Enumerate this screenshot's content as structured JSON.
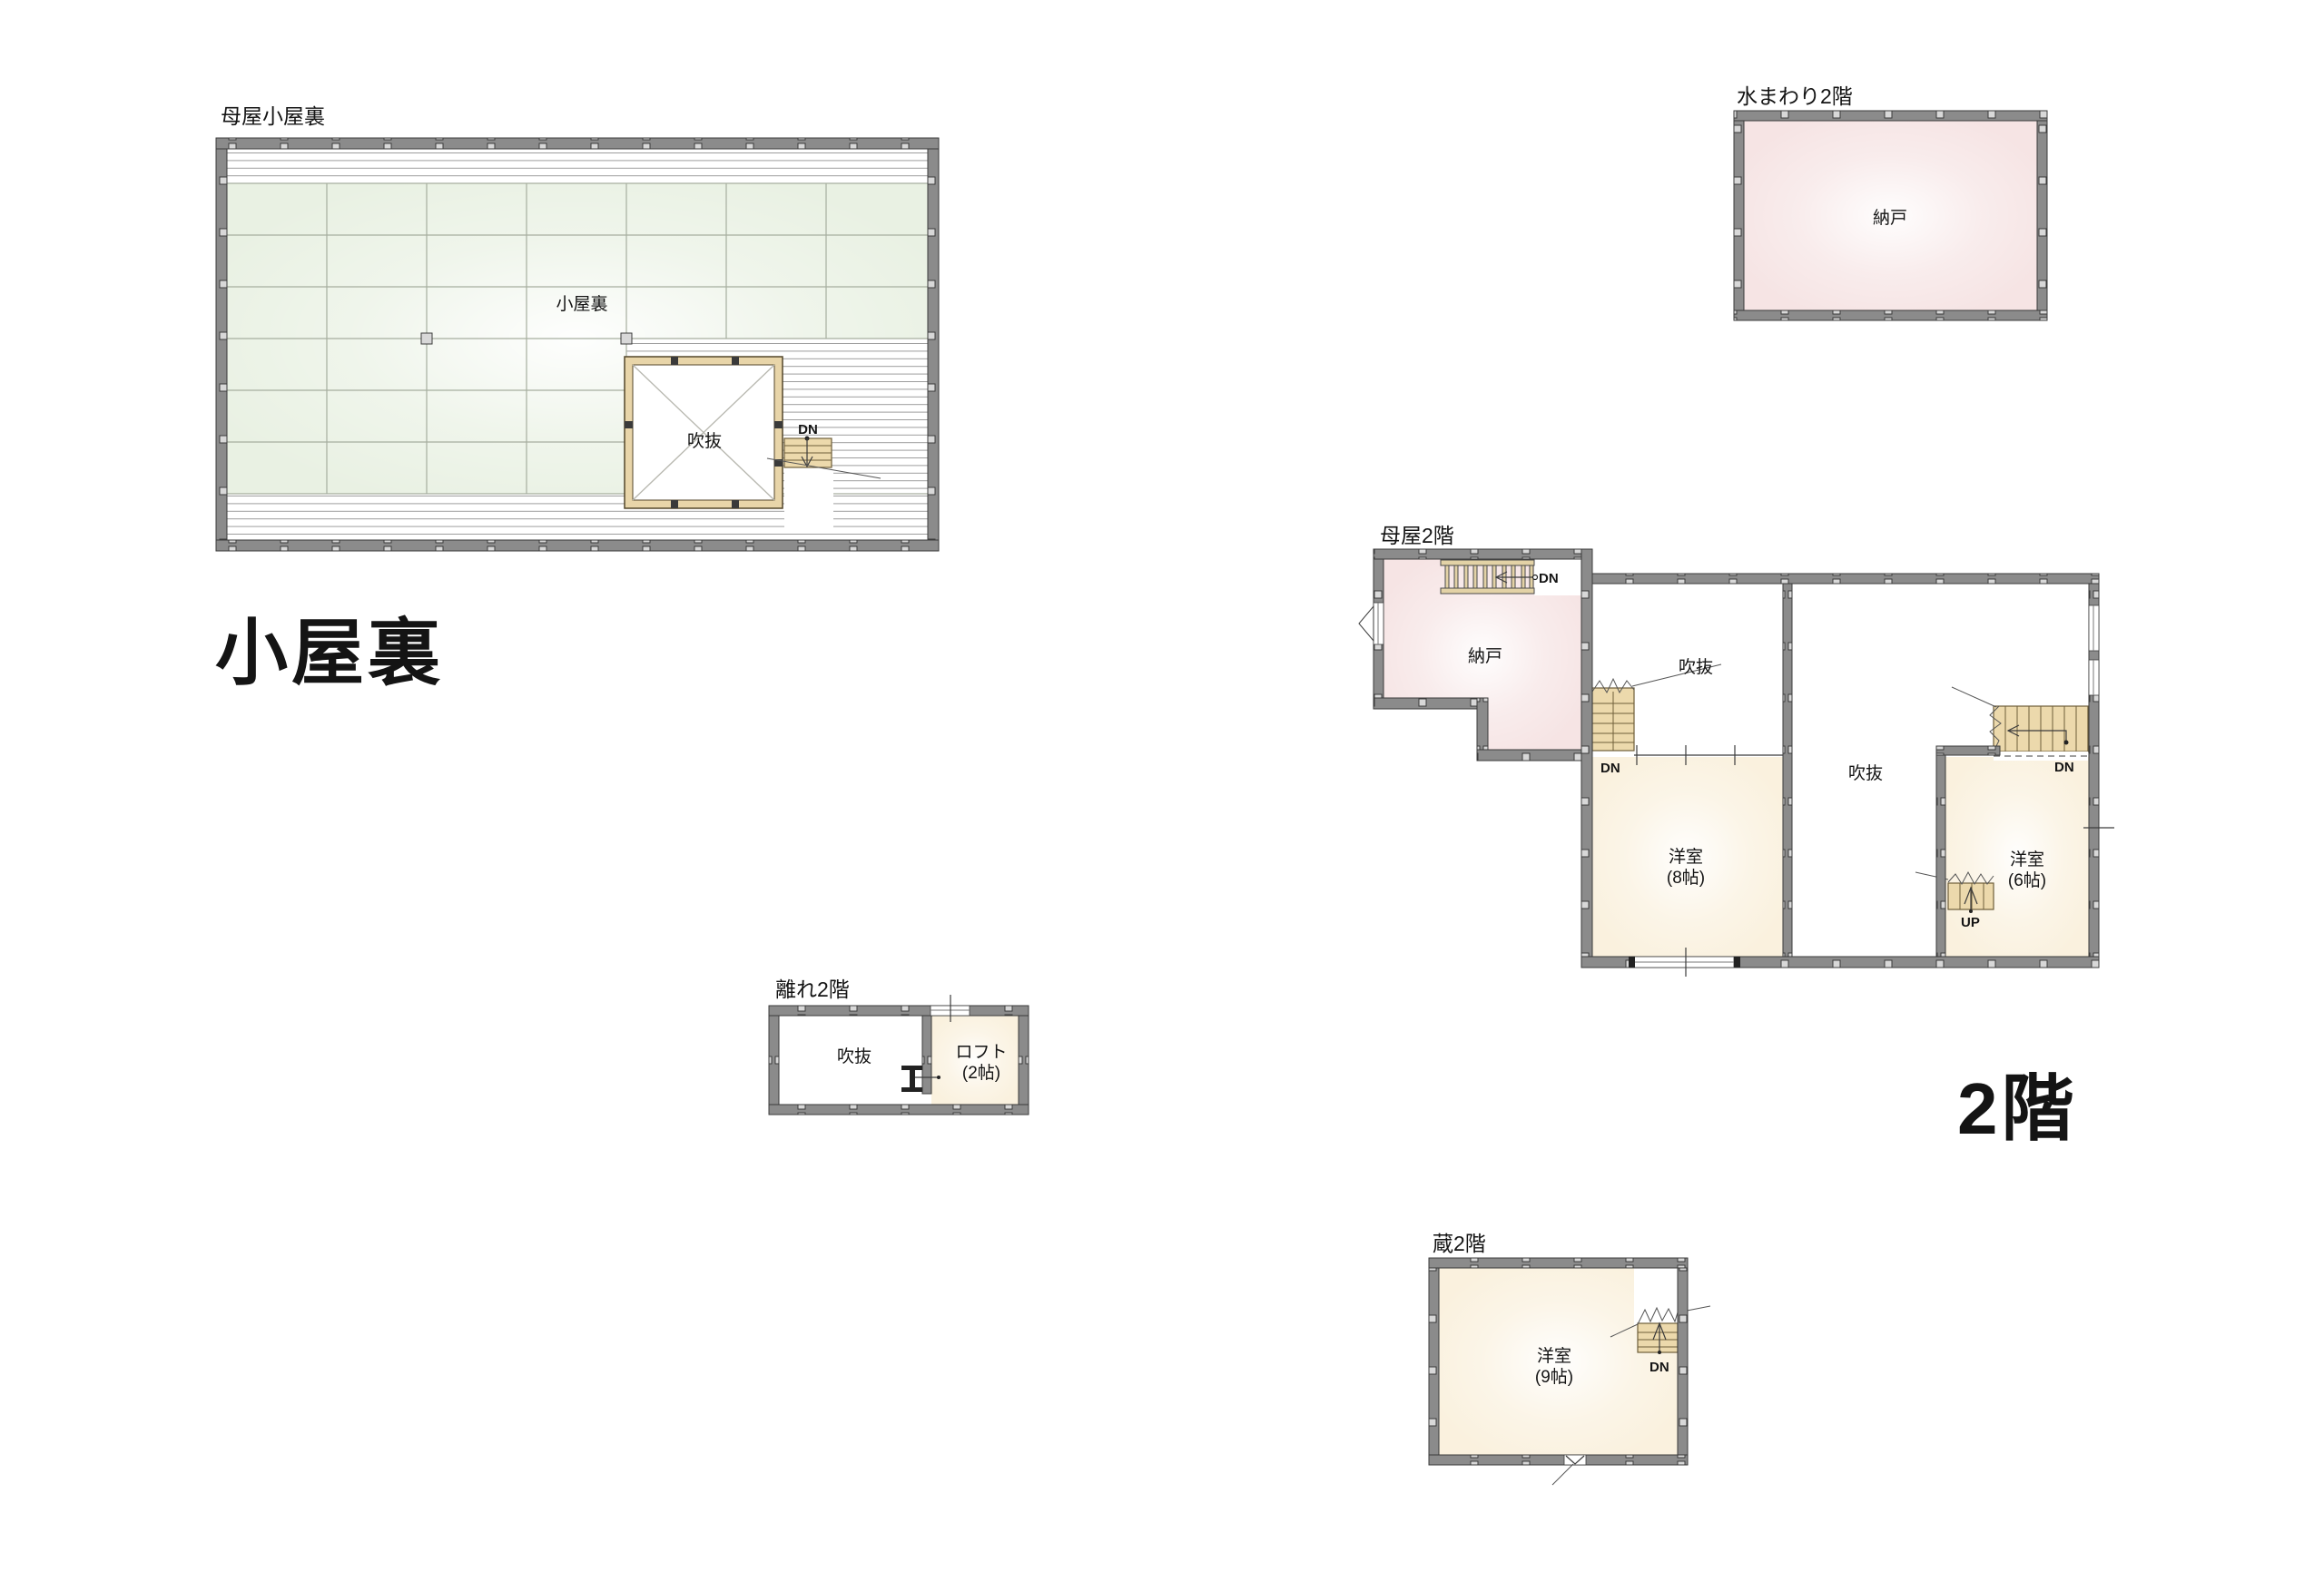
{
  "colors": {
    "wall": "#8b8b8b",
    "wall_post": "#d8d8d8",
    "wall_edge": "#3b3b3b",
    "green": "#e9f1e3",
    "grid_line": "#a6ae9f",
    "pink": "#f6e4e4",
    "cream": "#faf1de",
    "stair_tan": "#ecd9ac",
    "stair_line": "#6e5e3a",
    "hatch_line": "#9c9c9c",
    "void_border": "#e8d5a9",
    "text": "#141414"
  },
  "attic": {
    "title": "母屋小屋裏",
    "room_label": "小屋裏",
    "void_label": "吹抜",
    "stair_dn": "DN",
    "big_label": "小屋裏"
  },
  "mizumawari": {
    "title": "水まわり2階",
    "room_label": "納戸"
  },
  "omoya": {
    "title": "母屋2階",
    "nando_label": "納戸",
    "ladder_dn": "DN",
    "void_a_label": "吹抜",
    "void_b_label": "吹抜",
    "stair_a_dn": "DN",
    "stair_b_dn": "DN",
    "room8_label": "洋室",
    "room8_size": "(8帖)",
    "room6_label": "洋室",
    "room6_size": "(6帖)",
    "up_label": "UP"
  },
  "hanare": {
    "title": "離れ2階",
    "void_label": "吹抜",
    "loft_label": "ロフト",
    "loft_size": "(2帖)"
  },
  "kura": {
    "title": "蔵2階",
    "room_label": "洋室",
    "room_size": "(9帖)",
    "stair_dn": "DN"
  },
  "floor2_big_label": "2階"
}
